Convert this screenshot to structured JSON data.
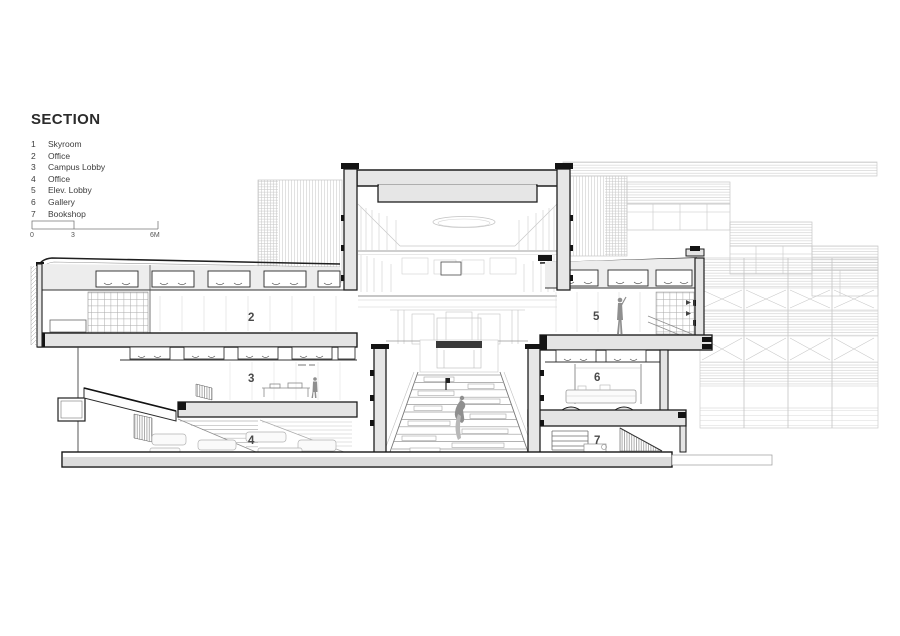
{
  "title": "SECTION",
  "legend": {
    "items": [
      {
        "num": "1",
        "label": "Skyroom"
      },
      {
        "num": "2",
        "label": "Office"
      },
      {
        "num": "3",
        "label": "Campus Lobby"
      },
      {
        "num": "4",
        "label": "Office"
      },
      {
        "num": "5",
        "label": "Elev. Lobby"
      },
      {
        "num": "6",
        "label": "Gallery"
      },
      {
        "num": "7",
        "label": "Bookshop"
      }
    ]
  },
  "scale_bar": {
    "ticks": [
      "0",
      "3",
      "6M"
    ]
  },
  "drawing": {
    "room_labels": [
      {
        "num": "2"
      },
      {
        "num": "3"
      },
      {
        "num": "4"
      },
      {
        "num": "5"
      },
      {
        "num": "6"
      },
      {
        "num": "7"
      }
    ]
  },
  "colors": {
    "poche": "#e4e4e4",
    "cut_line": "#1c1c1c",
    "light_line": "#c6c6c6",
    "label": "#4a4a4a"
  }
}
